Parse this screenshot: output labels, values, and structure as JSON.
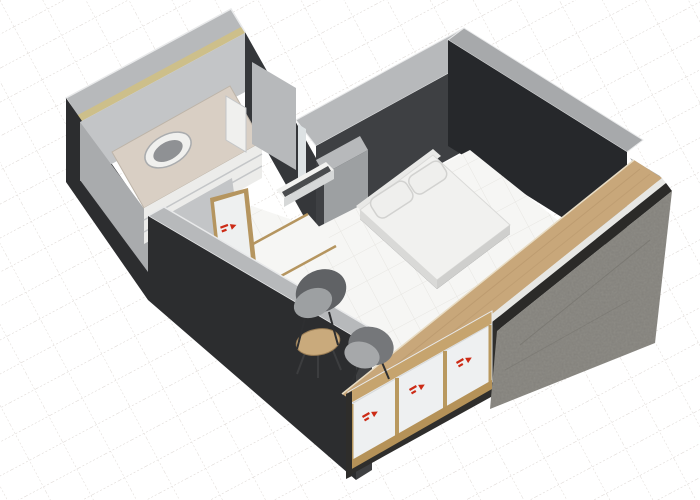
{
  "meta": {
    "description": "3D axonometric rendering of a small studio apartment floor plan on a white drafting grid",
    "view": "3d-axonometric",
    "visible_text": "none"
  },
  "canvas": {
    "width": 700,
    "height": 500
  },
  "colors": {
    "bg": "#ffffff",
    "grid_line": "#d9d3cf",
    "grid_line2": "#ded9d5",
    "floor": "#f6f6f4",
    "floor_line": "#e7e6e2",
    "wall_top": "#b7b9bb",
    "wall_top_shade": "#a7a9ab",
    "wall_top_highlight": "#e8e9ea",
    "insulation": "#cdbf8a",
    "wall_dark_outer": "#2c2d2f",
    "wall_charcoal": "#3e4043",
    "wall_darkest": "#26282b",
    "wall_dark_interior": "#35373a",
    "wall_endface": "#3f4042",
    "wall_light": "#c3c5c7",
    "wall_light_shade": "#a9abad",
    "slab_dark": "#9da0a2",
    "counter": "#d9cfc4",
    "counter_edge": "#bdb4a8",
    "cabinet": "#ececea",
    "cabinet_line": "#c4c6c8",
    "fixture_white": "#f0f0ee",
    "sink_basin": "#8f9194",
    "sink_edge": "#aaacae",
    "wood_frame": "#b5955f",
    "door_white": "#eef0f0",
    "glass_pane": "#dde2e4",
    "niche_top": "#f2f2f0",
    "niche_front": "#d6d8d8",
    "niche_slot": "#4a4c4e",
    "bed_mattress": "#f1f1ef",
    "mattress_edge": "#dadad8",
    "bed_side": "#d9d9d7",
    "bed_side2": "#cfcfcd",
    "bed_base": "#3a3b3d",
    "headboard": "#e9e9e7",
    "pillow": "#efefed",
    "pillow_edge": "#d2d2d0",
    "closet_dark": "#2f2e2c",
    "wood": "#c8a77a",
    "wood_highlight": "#e8dcc4",
    "wood_grain": "#b6956a",
    "layer_light": "#e7e7e4",
    "layer_dark": "#2b2a28",
    "concrete": "#8f8d87",
    "concrete_speckle": "#000000",
    "concrete_line": "#6f6d67",
    "rail_wood": "#c6a46e",
    "rail_bottom": "#b59258",
    "jamb": "#2e2d2b",
    "glass": "#eef0f1",
    "glass_edge": "#d7dadb",
    "mullion": "#b9995f",
    "decal_red": "#cc2b16",
    "table": "#c9aa7c",
    "table_edge": "#9a7d55",
    "leg": "#3c3d3f",
    "chair_leg": "#2e2f31",
    "chair1_back": "#606265",
    "chair1_seat": "#9da0a2",
    "chair2_back": "#75777a",
    "chair2_seat": "#a6a8aa"
  },
  "scene": {
    "rooms": [
      {
        "id": "bathroom",
        "elements": [
          "vanity-counter",
          "sink",
          "vanity-drawers",
          "storage-cabinet",
          "bathroom-door"
        ]
      },
      {
        "id": "living-bedroom",
        "elements": [
          "double-bed",
          "pillow-1",
          "pillow-2",
          "wall-niche-shelf",
          "lounge-chair-1",
          "lounge-chair-2",
          "round-coffee-table"
        ]
      },
      {
        "id": "closet",
        "elements": [
          "sliding-glass-door-1",
          "sliding-glass-door-2",
          "sliding-glass-door-3"
        ]
      }
    ],
    "construction": [
      "insulated-perimeter-walls",
      "concrete-exterior-wall",
      "wood-clad-wall-top",
      "interior-partitions"
    ]
  }
}
